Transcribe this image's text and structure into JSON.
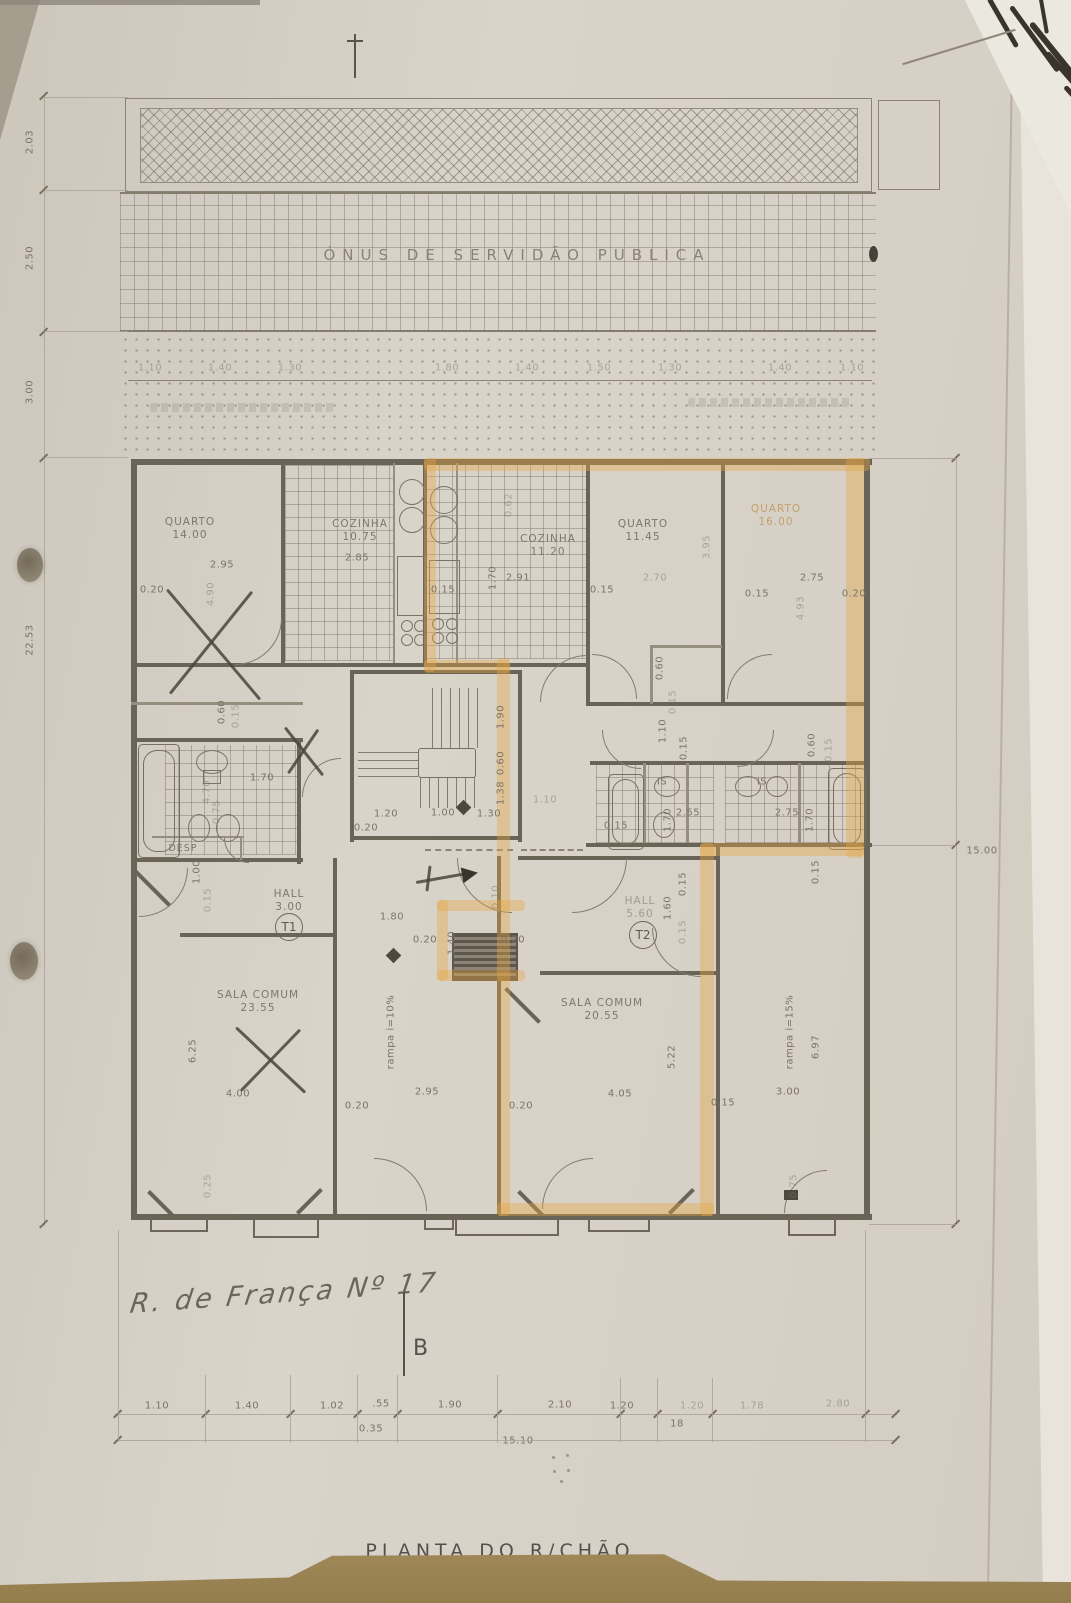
{
  "texts": {
    "servidao_band": "ÓNUS DE SERVIDÃO PUBLICA",
    "drawing_title": "PLANTA DO R/CHÃO",
    "handwritten_note": "R. de França Nº 17",
    "section_letter": "B"
  },
  "colors": {
    "highlighter": "#e7a642",
    "pencil": "#4a443c",
    "paper": "#d6d0c6",
    "table": "#a68d5e"
  },
  "unit_markers": [
    {
      "label": "T1",
      "x": 289,
      "y": 927
    },
    {
      "label": "T2",
      "x": 643,
      "y": 935
    }
  ],
  "room_labels": [
    {
      "name": "QUARTO",
      "area": "14.00",
      "x": 190,
      "y": 529
    },
    {
      "name": "COZINHA",
      "area": "10.75",
      "x": 360,
      "y": 531
    },
    {
      "name": "COZINHA",
      "area": "11.20",
      "x": 548,
      "y": 546
    },
    {
      "name": "QUARTO",
      "area": "11.45",
      "x": 643,
      "y": 531
    },
    {
      "name": "QUARTO",
      "area": "16.00",
      "x": 776,
      "y": 516,
      "cls": "fo"
    },
    {
      "name": "DESP",
      "area": "",
      "x": 183,
      "y": 849,
      "cls": "sm"
    },
    {
      "name": "HALL",
      "area": "3.00",
      "x": 289,
      "y": 901
    },
    {
      "name": "HALL",
      "area": "5.60",
      "x": 640,
      "y": 908,
      "cls": "fnt"
    },
    {
      "name": "SALA COMUM",
      "area": "23.55",
      "x": 258,
      "y": 1002
    },
    {
      "name": "SALA COMUM",
      "area": "20.55",
      "x": 602,
      "y": 1010
    }
  ],
  "dim_labels": [
    {
      "t": "1.10",
      "x": 150,
      "y": 368,
      "f": 1
    },
    {
      "t": "1.40",
      "x": 220,
      "y": 368,
      "f": 1
    },
    {
      "t": "1.30",
      "x": 290,
      "y": 368,
      "f": 1
    },
    {
      "t": "1.80",
      "x": 447,
      "y": 368,
      "f": 1
    },
    {
      "t": "1.40",
      "x": 527,
      "y": 368,
      "f": 1
    },
    {
      "t": "1.50",
      "x": 599,
      "y": 368,
      "f": 1
    },
    {
      "t": "1.30",
      "x": 670,
      "y": 368,
      "f": 1
    },
    {
      "t": "1.40",
      "x": 780,
      "y": 368,
      "f": 1
    },
    {
      "t": "1.10",
      "x": 852,
      "y": 368,
      "f": 1
    },
    {
      "t": "2.03",
      "x": 30,
      "y": 142,
      "r": -90
    },
    {
      "t": "2.50",
      "x": 30,
      "y": 258,
      "r": -90
    },
    {
      "t": "3.00",
      "x": 30,
      "y": 392,
      "r": -90
    },
    {
      "t": "22.53",
      "x": 30,
      "y": 640,
      "r": -90
    },
    {
      "t": "15.00",
      "x": 982,
      "y": 851
    },
    {
      "t": "0.20",
      "x": 152,
      "y": 590
    },
    {
      "t": "2.95",
      "x": 222,
      "y": 565
    },
    {
      "t": "4.90",
      "x": 211,
      "y": 594,
      "r": -90,
      "f": 1
    },
    {
      "t": "0.15",
      "x": 443,
      "y": 590
    },
    {
      "t": "2.85",
      "x": 357,
      "y": 558
    },
    {
      "t": "0.62",
      "x": 509,
      "y": 505,
      "r": -90,
      "f": 1
    },
    {
      "t": "1.70",
      "x": 493,
      "y": 578,
      "r": -90
    },
    {
      "t": "2.91",
      "x": 518,
      "y": 578
    },
    {
      "t": "0.15",
      "x": 602,
      "y": 590
    },
    {
      "t": "3.95",
      "x": 707,
      "y": 547,
      "r": -90,
      "f": 1
    },
    {
      "t": "2.70",
      "x": 655,
      "y": 578,
      "f": 1
    },
    {
      "t": "2.75",
      "x": 812,
      "y": 578
    },
    {
      "t": "0.15",
      "x": 757,
      "y": 594
    },
    {
      "t": "0.20",
      "x": 854,
      "y": 594
    },
    {
      "t": "4.93",
      "x": 801,
      "y": 608,
      "r": -90,
      "f": 1
    },
    {
      "t": "0.60",
      "x": 660,
      "y": 668,
      "r": -90
    },
    {
      "t": "0.15",
      "x": 673,
      "y": 702,
      "r": -90,
      "f": 1
    },
    {
      "t": "0.60",
      "x": 222,
      "y": 712,
      "r": -90
    },
    {
      "t": "0.15",
      "x": 236,
      "y": 716,
      "r": -90,
      "f": 1
    },
    {
      "t": "1.70",
      "x": 262,
      "y": 778
    },
    {
      "t": "4.70",
      "x": 207,
      "y": 792,
      "r": -90,
      "f": 1
    },
    {
      "t": "0.75",
      "x": 217,
      "y": 812,
      "r": -90,
      "f": 1
    },
    {
      "t": "1.00",
      "x": 197,
      "y": 872,
      "r": -90
    },
    {
      "t": "0.15",
      "x": 208,
      "y": 900,
      "r": -90,
      "f": 1
    },
    {
      "t": "1.90",
      "x": 501,
      "y": 717,
      "r": -90
    },
    {
      "t": "0.60",
      "x": 501,
      "y": 763,
      "r": -90
    },
    {
      "t": "1.38",
      "x": 501,
      "y": 793,
      "r": -90
    },
    {
      "t": "1.20",
      "x": 386,
      "y": 814
    },
    {
      "t": "1.00",
      "x": 443,
      "y": 813
    },
    {
      "t": "1.30",
      "x": 489,
      "y": 814
    },
    {
      "t": "0.20",
      "x": 366,
      "y": 828
    },
    {
      "t": "1.10",
      "x": 545,
      "y": 800,
      "f": 1
    },
    {
      "t": "1.10",
      "x": 663,
      "y": 731,
      "r": -90
    },
    {
      "t": "0.15",
      "x": 684,
      "y": 748,
      "r": -90
    },
    {
      "t": "IS",
      "x": 662,
      "y": 782
    },
    {
      "t": "0.15",
      "x": 616,
      "y": 826
    },
    {
      "t": "2.55",
      "x": 688,
      "y": 813
    },
    {
      "t": "1.70",
      "x": 668,
      "y": 820,
      "r": -90
    },
    {
      "t": "IS",
      "x": 762,
      "y": 782
    },
    {
      "t": "2.75",
      "x": 787,
      "y": 813
    },
    {
      "t": "1.70",
      "x": 810,
      "y": 820,
      "r": -90
    },
    {
      "t": "0.60",
      "x": 812,
      "y": 745,
      "r": -90
    },
    {
      "t": "0.15",
      "x": 829,
      "y": 750,
      "r": -90,
      "f": 1
    },
    {
      "t": "1.60",
      "x": 668,
      "y": 908,
      "r": -90
    },
    {
      "t": "0.15",
      "x": 683,
      "y": 884,
      "r": -90
    },
    {
      "t": "0.15",
      "x": 683,
      "y": 932,
      "r": -90,
      "f": 1
    },
    {
      "t": "1.80",
      "x": 392,
      "y": 917
    },
    {
      "t": "0.20",
      "x": 425,
      "y": 940
    },
    {
      "t": "1.40",
      "x": 452,
      "y": 943,
      "r": -90
    },
    {
      "t": "0.20",
      "x": 513,
      "y": 940
    },
    {
      "t": "0.10",
      "x": 496,
      "y": 897,
      "r": -90,
      "f": 1
    },
    {
      "t": "rampa i=10%",
      "x": 391,
      "y": 1032,
      "r": -90
    },
    {
      "t": "rampa i=15%",
      "x": 790,
      "y": 1032,
      "r": -90
    },
    {
      "t": "6.25",
      "x": 193,
      "y": 1051,
      "r": -90
    },
    {
      "t": "4.00",
      "x": 238,
      "y": 1094
    },
    {
      "t": "0.20",
      "x": 357,
      "y": 1106
    },
    {
      "t": "2.95",
      "x": 427,
      "y": 1092
    },
    {
      "t": "5.22",
      "x": 672,
      "y": 1057,
      "r": -90
    },
    {
      "t": "4.05",
      "x": 620,
      "y": 1094
    },
    {
      "t": "0.20",
      "x": 521,
      "y": 1106
    },
    {
      "t": "0.15",
      "x": 723,
      "y": 1103
    },
    {
      "t": "3.00",
      "x": 788,
      "y": 1092
    },
    {
      "t": "6.97",
      "x": 816,
      "y": 1047,
      "r": -90
    },
    {
      "t": "0.15",
      "x": 816,
      "y": 872,
      "r": -90
    },
    {
      "t": "0.75",
      "x": 794,
      "y": 1186,
      "r": -90,
      "f": 1
    },
    {
      "t": "0.25",
      "x": 208,
      "y": 1186,
      "r": -90,
      "f": 1
    },
    {
      "t": "1.10",
      "x": 157,
      "y": 1406
    },
    {
      "t": "1.40",
      "x": 247,
      "y": 1406
    },
    {
      "t": "1.02",
      "x": 332,
      "y": 1406
    },
    {
      "t": ".55",
      "x": 381,
      "y": 1404
    },
    {
      "t": "1.90",
      "x": 450,
      "y": 1405
    },
    {
      "t": "2.10",
      "x": 560,
      "y": 1405
    },
    {
      "t": "1.20",
      "x": 622,
      "y": 1406
    },
    {
      "t": "1.20",
      "x": 692,
      "y": 1406,
      "f": 1
    },
    {
      "t": "1.78",
      "x": 752,
      "y": 1406,
      "f": 1
    },
    {
      "t": "2.80",
      "x": 838,
      "y": 1404,
      "f": 1
    },
    {
      "t": "0.35",
      "x": 371,
      "y": 1429
    },
    {
      "t": "18",
      "x": 677,
      "y": 1424
    },
    {
      "t": "15.10",
      "x": 518,
      "y": 1441
    }
  ],
  "highlights": [
    {
      "x": 424,
      "y": 458,
      "w": 446,
      "h": 13
    },
    {
      "x": 424,
      "y": 458,
      "w": 12,
      "h": 214
    },
    {
      "x": 846,
      "y": 458,
      "w": 18,
      "h": 400
    },
    {
      "x": 424,
      "y": 660,
      "w": 86,
      "h": 13
    },
    {
      "x": 497,
      "y": 658,
      "w": 13,
      "h": 558
    },
    {
      "x": 700,
      "y": 843,
      "w": 164,
      "h": 13
    },
    {
      "x": 700,
      "y": 843,
      "w": 14,
      "h": 373
    },
    {
      "x": 497,
      "y": 1203,
      "w": 217,
      "h": 13
    },
    {
      "x": 437,
      "y": 900,
      "w": 88,
      "h": 11
    },
    {
      "x": 437,
      "y": 900,
      "w": 11,
      "h": 81
    },
    {
      "x": 437,
      "y": 970,
      "w": 88,
      "h": 11
    }
  ],
  "pencil_strokes": [
    {
      "x": 167,
      "y": 588,
      "len": 144,
      "rot": 49.8
    },
    {
      "x": 252,
      "y": 590,
      "len": 131,
      "rot": 128.8
    },
    {
      "x": 285,
      "y": 726,
      "len": 61,
      "rot": 51.6
    },
    {
      "x": 318,
      "y": 728,
      "len": 53,
      "rot": 124.3
    },
    {
      "x": 236,
      "y": 1026,
      "len": 95,
      "rot": 43.3
    },
    {
      "x": 300,
      "y": 1028,
      "len": 85,
      "rot": 134
    },
    {
      "x": 416,
      "y": 881,
      "len": 50,
      "rot": -10
    },
    {
      "x": 430,
      "y": 864,
      "len": 26,
      "rot": 97
    }
  ]
}
